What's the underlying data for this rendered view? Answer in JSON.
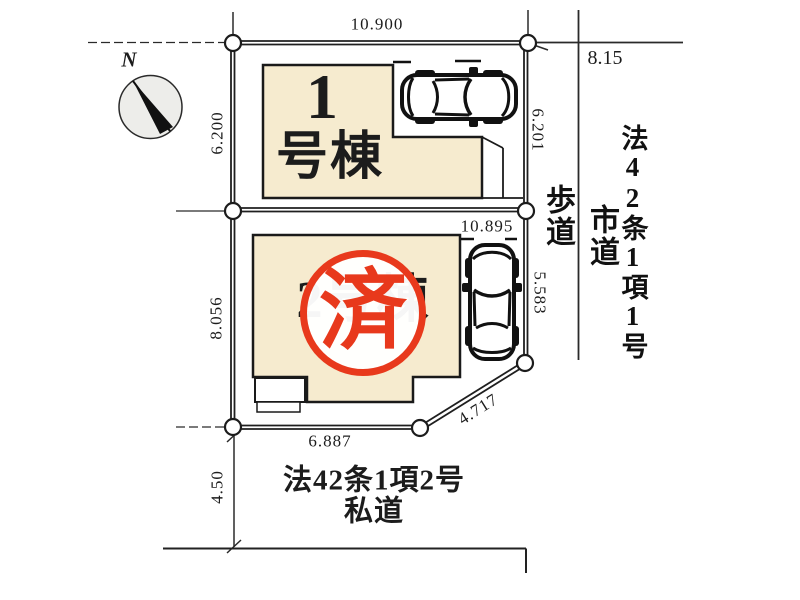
{
  "compass": {
    "north_label": "N"
  },
  "lot1": {
    "building_number": "1",
    "building_suffix": "号棟",
    "dim_top": "10.900",
    "dim_left": "6.200",
    "dim_right": "6.201"
  },
  "lot2": {
    "building_label": "2号棟",
    "dim_top": "10.895",
    "dim_left": "8.056",
    "dim_right": "5.583",
    "dim_diagonal": "4.717",
    "dim_bottom": "6.887"
  },
  "stamp": {
    "label": "済"
  },
  "roads": {
    "sidewalk_label": "歩道",
    "east_road_dim": "8.15",
    "east_road_law": "法42条1項1号",
    "east_road_type": "市道",
    "south_road_law": "法42条1項2号",
    "south_road_type": "私道",
    "south_road_width": "4.50"
  },
  "colors": {
    "building_fill": "#f6ebcf",
    "stamp_red": "#e8391c",
    "line_color": "#1c1c1c",
    "compass_fill": "#ededea"
  }
}
